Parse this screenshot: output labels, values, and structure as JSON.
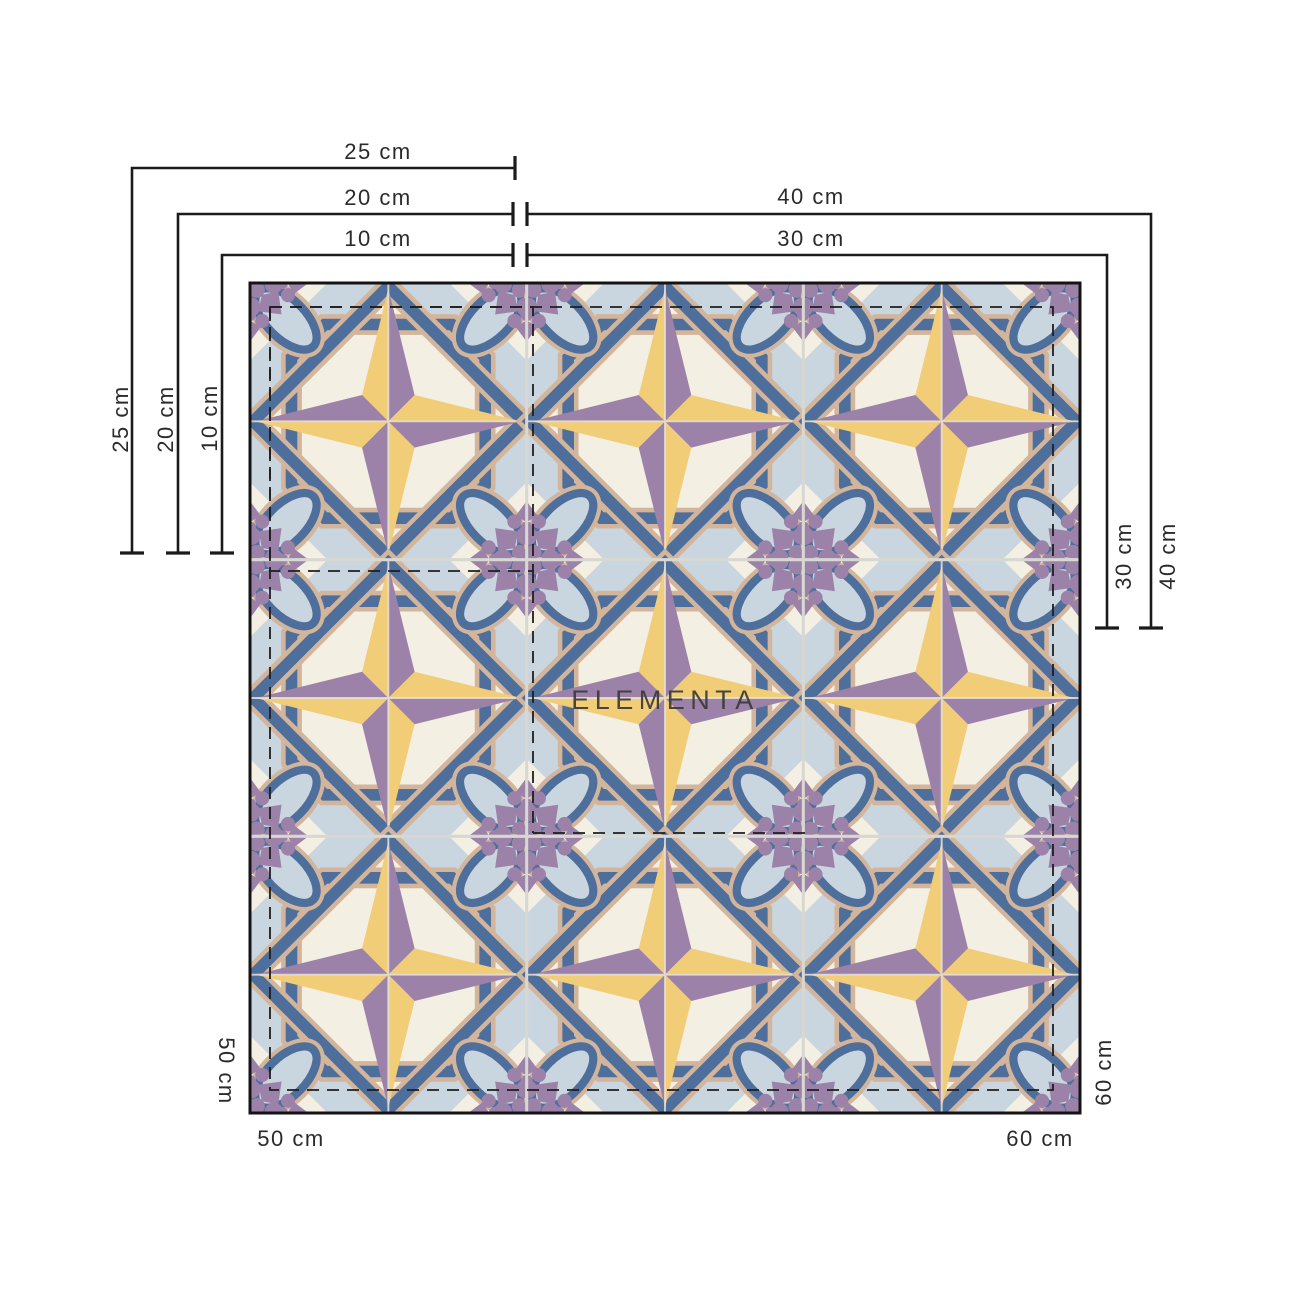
{
  "watermark": "ELEMENTA",
  "dimension_labels": {
    "top_25": "25 cm",
    "top_20": "20 cm",
    "top_10": "10 cm",
    "top_40": "40 cm",
    "top_30": "30 cm",
    "left_25": "25 cm",
    "left_20": "20 cm",
    "left_10": "10 cm",
    "right_30": "30 cm",
    "right_40": "40 cm",
    "bottom_left_side": "50 cm",
    "bottom_left": "50 cm",
    "bottom_right_side": "60 cm",
    "bottom_right": "60 cm"
  },
  "grid": {
    "rows": 3,
    "cols": 3
  },
  "palette": {
    "cream": "#F3EFE2",
    "light_blue": "#C9D6DF",
    "steel_blue": "#4E6F9B",
    "tan": "#D3B59C",
    "purple": "#9C82A8",
    "yellow": "#F1CD78",
    "grout": "#D8D8D2",
    "dimension_line": "#1b1b1b",
    "label_text": "#2b2b2b"
  }
}
